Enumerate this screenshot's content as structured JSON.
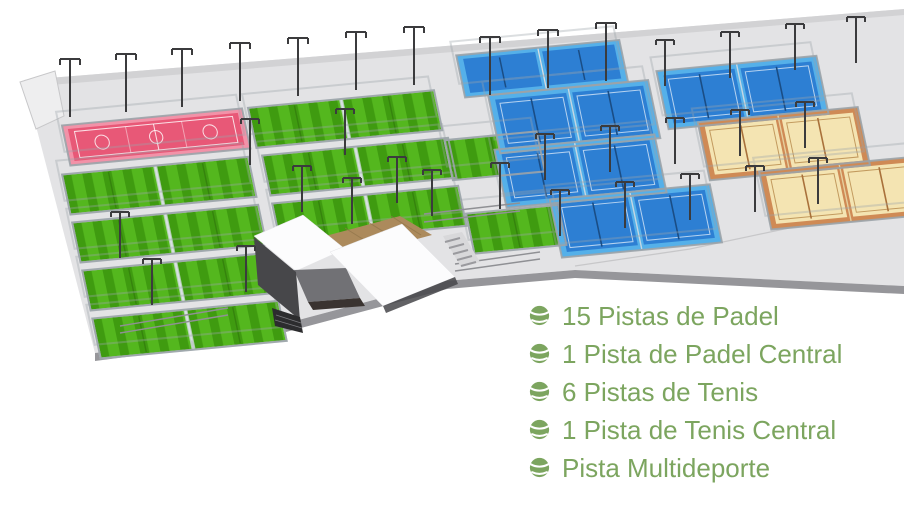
{
  "legend": {
    "items": [
      {
        "icon": "tennis-ball-icon",
        "label": "15 Pistas de Padel"
      },
      {
        "icon": "tennis-ball-icon",
        "label": "1 Pista de Padel Central"
      },
      {
        "icon": "tennis-ball-icon",
        "label": "6 Pistas de Tenis"
      },
      {
        "icon": "tennis-ball-icon",
        "label": "1 Pista de Tenis Central"
      },
      {
        "icon": "tennis-ball-icon",
        "label": "Pista Multideporte"
      }
    ]
  },
  "colors": {
    "background": "#ffffff",
    "platform": "#e3e3e5",
    "platform_rim": "#d2d2d4",
    "platform_side": "#96969a",
    "platform_edge": "#c7c7c9",
    "fence": "#9ba3a9",
    "pole": "#3b3b3d",
    "grass_light": "#54b71e",
    "grass_dark": "#3f9b10",
    "green_wall": "#d4dee2",
    "green_net": "#35830d",
    "blue_surround": "#55b0e9",
    "blue_court": "#2d7fd3",
    "blue_net": "#1a4d85",
    "court_divider": "#d8dee2",
    "orange_surround": "#cf8a55",
    "orange_court": "#f4e4b2",
    "orange_line": "#c29a5e",
    "orange_net": "#a9713b",
    "pink_surround": "#f292a8",
    "pink_court": "#e85877",
    "building_white": "#fcfcfd",
    "building_dark": "#47474a",
    "building_mid": "#717175",
    "building_steps": "#2c2c2e",
    "deck": "#ac8a5c",
    "deck_line": "#8f7349",
    "railing": "#8f9094",
    "legend_green": "#7ca55f"
  }
}
